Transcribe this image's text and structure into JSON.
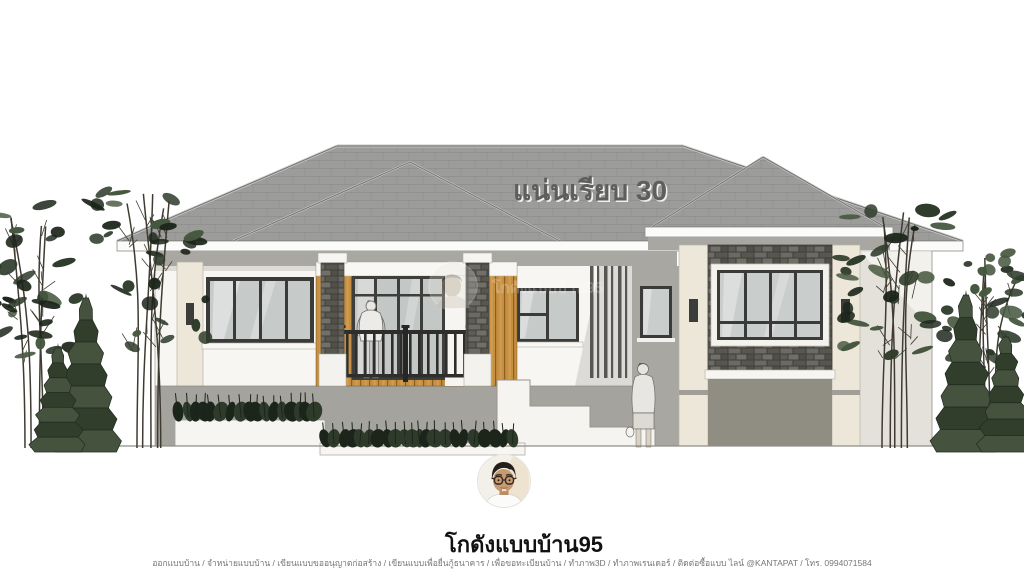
{
  "rendering": {
    "roof_label": "แน่นเรียบ 30",
    "scene_description": "single-story house front elevation rendering"
  },
  "watermark": {
    "text": "โกดังแบบบ้าน95"
  },
  "branding": {
    "name": "โกดังแบบบ้าน95",
    "services_line": "ออกแบบบ้าน / จำหน่ายแบบบ้าน / เขียนแบบขออนุญาตก่อสร้าง / เขียนแบบเพื่อยื่นกู้ธนาคาร / เพื่อขอทะเบียนบ้าน / ทำภาพ3D / ทำภาพเรนเดอร์ / ติดต่อซื้อแบบ ไลน์ @KANTAPAT / โทร. 0994071584"
  },
  "colors": {
    "background": "#ffffff",
    "roof": "#9c9c9a",
    "roof_line": "#5f5f5d",
    "roof_cap": "#c6c6c4",
    "fascia": "#fbfbf9",
    "wall_white": "#f7f6f2",
    "wall_cream": "#ece7d9",
    "wall_gray": "#a9a7a1",
    "plinth_gray": "#a5a39d",
    "wing_lower_wall": "#908e82",
    "wood_accent": "#c68f41",
    "stone_accent": "#4a4945",
    "window_glass": "#c6cac8",
    "window_frame": "#3a3a38",
    "railing": "#2e2e2c",
    "foliage_dark": "#1c251a",
    "foliage_mid": "#2e3b2b",
    "foliage_light": "#46573f",
    "tree_stem": "#3f3b31",
    "brand_text": "#111111",
    "footer_text": "#787672"
  }
}
